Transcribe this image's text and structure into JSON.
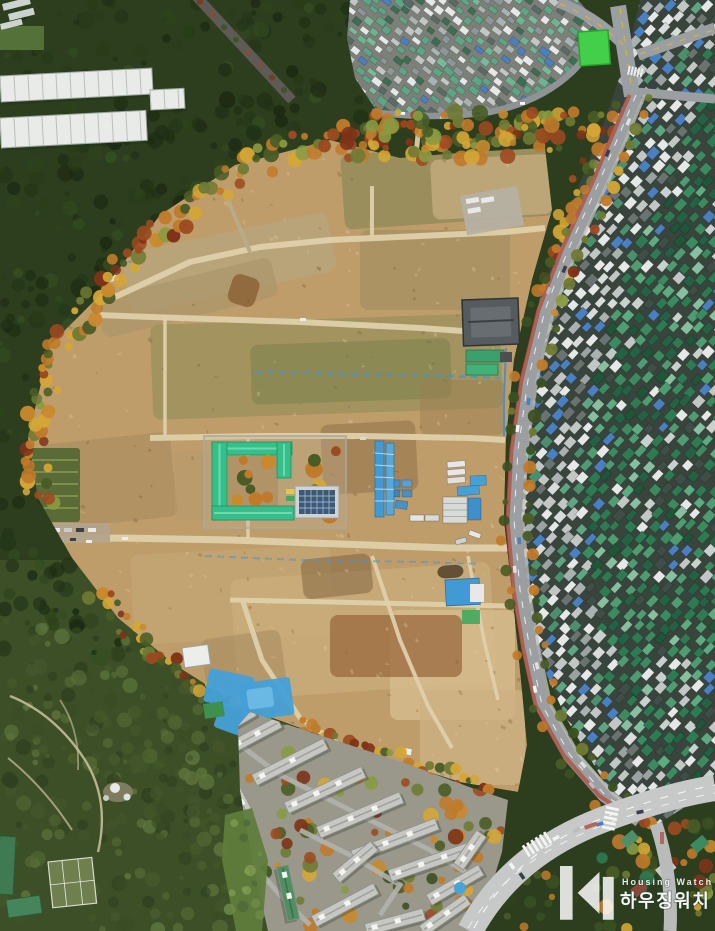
{
  "watermark": {
    "brand_en": "Housing Watch",
    "brand_ko": "하우징워치",
    "text_color": "#ffffff"
  },
  "palette": {
    "forest_base": "#2c3e1d",
    "forest_dark": "#243618",
    "forest_south": "#4a5c2f",
    "meadow_green": "#5f7c3c",
    "dirt_base": "#bf9d6b",
    "dirt_path": "#ded0ab",
    "autumn_orange": "#c07a2a",
    "autumn_yellow": "#d4a636",
    "autumn_red": "#9c4a20",
    "village_roof_green": "#5ea486",
    "dense_roof_green": "#2e7a52",
    "roof_grey": "#c2c7c6",
    "roof_white": "#e6e8e7",
    "roof_blue": "#4a7fc0",
    "school_roof_green": "#35c08b",
    "solar_panel_blue": "#3b5a7a",
    "tarp_blue": "#45a0d8",
    "road_grey": "#9b9fa2",
    "road_light": "#c7c9c8",
    "bus_lane_red": "#b05546",
    "court_green": "#43cf49",
    "apartment_grey": "#c6c7c2",
    "lane_yellow": "#d4b23c"
  }
}
